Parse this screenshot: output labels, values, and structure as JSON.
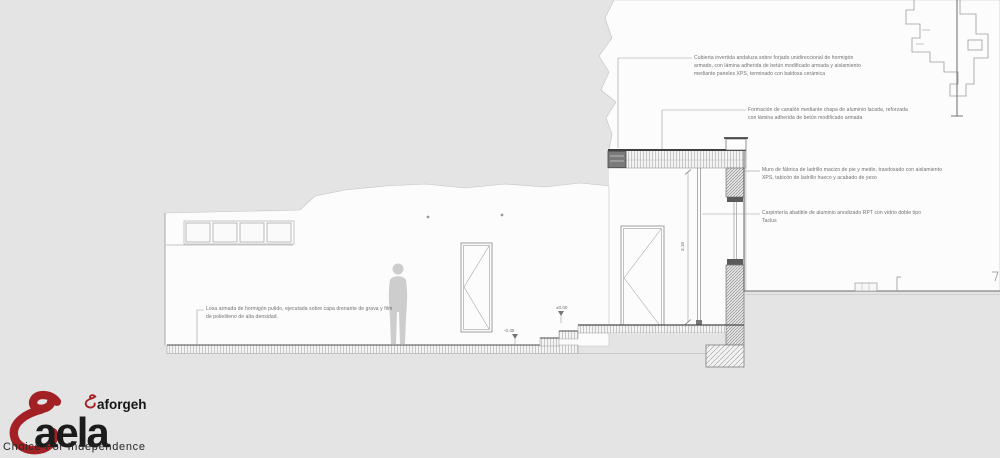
{
  "drawing": {
    "annotations": [
      {
        "id": "cubierta",
        "text": "Cubierta invertida andaluza sobre forjado unidireccional de hormigón armado, con lámina adherida de betún modificado armada y aislamiento mediante paneles XPS, terminado con baldosa cerámica"
      },
      {
        "id": "canalon",
        "text": "Formación de canalón mediante chapa de aluminio lacada, reforzada con lámina adherida de betún modificado armada"
      },
      {
        "id": "muro",
        "text": "Muro de fábrica de ladrillo macizo de pie y medio, trasdosado con aislamiento XPS, tabicón de ladrillo hueco y acabado de yeso"
      },
      {
        "id": "carpinteria",
        "text": "Carpintería abatible de aluminio anodizado RPT con vidrio doble tipo Taclus"
      },
      {
        "id": "losa",
        "text": "Losa armada de hormigón pulido, ejecutada sobre capa drenante de grava y film de polietileno de alta densidad."
      }
    ],
    "levels": {
      "upper": "±0.00",
      "lower": "-0.45"
    },
    "dimensions": {
      "height": "3.18"
    }
  },
  "logo": {
    "brand": "aela",
    "sub": "aforgeh",
    "tagline": "Choice For Independence",
    "accent": "#a32025",
    "ink": "#1b1b1b"
  },
  "colors": {
    "background": "#e4e4e4",
    "paper": "#fcfcfc",
    "line_dark": "#3f3f3f",
    "line_mid": "#8a8a8a",
    "annotation": "#6e6e6e"
  }
}
